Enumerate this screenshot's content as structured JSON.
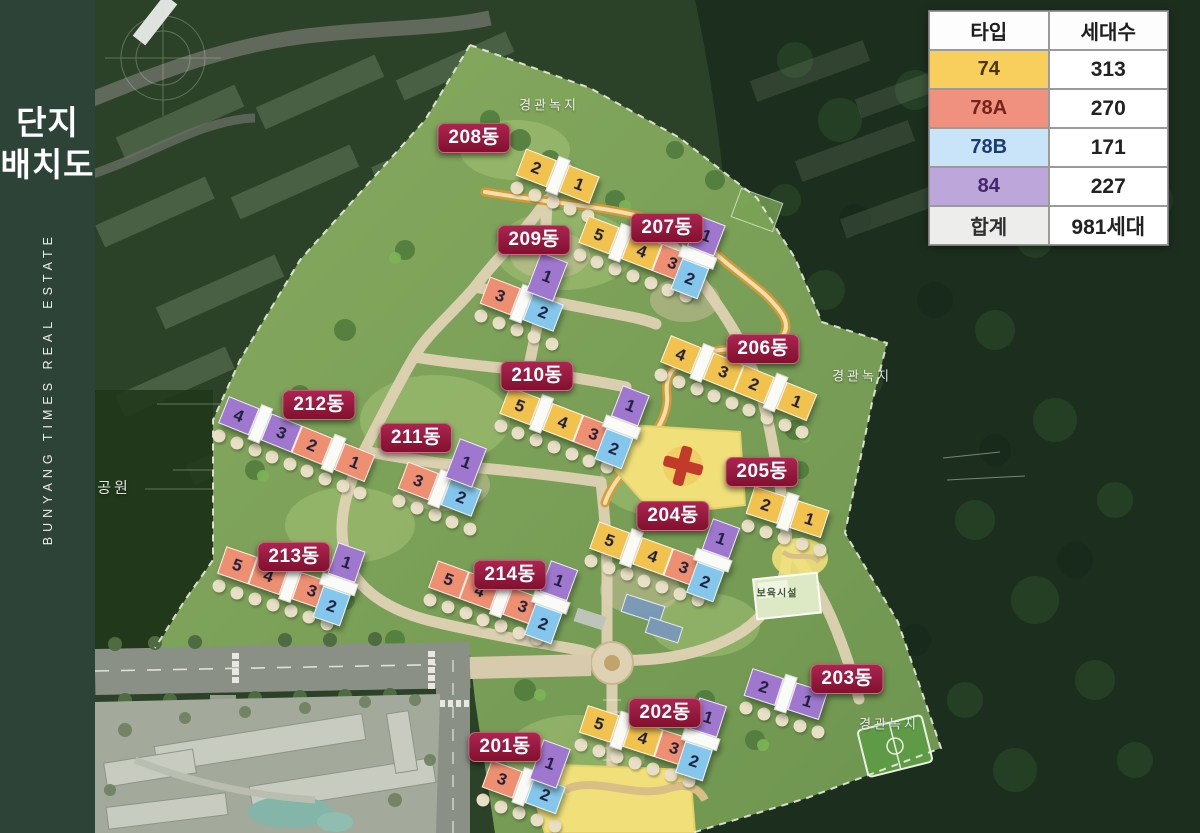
{
  "sidebar": {
    "title_line1": "단지",
    "title_line2": "배치도",
    "vertical_text": "BUNYANG TIMES REAL ESTATE"
  },
  "legend_table": {
    "headers": [
      "타입",
      "세대수"
    ],
    "rows": [
      {
        "type": "74",
        "count": "313",
        "color": "#F8CE5C",
        "text_color": "#4A3508"
      },
      {
        "type": "78A",
        "count": "270",
        "color": "#F0907E",
        "text_color": "#73231A"
      },
      {
        "type": "78B",
        "count": "171",
        "color": "#C9E4F8",
        "text_color": "#1A3C70"
      },
      {
        "type": "84",
        "count": "227",
        "color": "#BCA6DA",
        "text_color": "#45256E"
      },
      {
        "type": "합계",
        "count": "981세대",
        "color": "#EDEDEC",
        "text_color": "#2F2F2F"
      }
    ]
  },
  "map": {
    "type_colors": {
      "74": "#F2C24E",
      "78A": "#EE8F72",
      "78B": "#85C7EC",
      "84": "#9F77CE"
    },
    "badge_color": "#9A1C40",
    "area_labels": [
      {
        "text": "경관녹지",
        "x": 454,
        "y": 104,
        "size": 13
      },
      {
        "text": "경관녹지",
        "x": 767,
        "y": 375,
        "size": 13
      },
      {
        "text": "경관녹지",
        "x": 794,
        "y": 723,
        "size": 13
      },
      {
        "text": "공원",
        "x": 19,
        "y": 487,
        "size": 15
      },
      {
        "text": "보육시설",
        "x": 682,
        "y": 592,
        "size": 10
      }
    ],
    "buildings": [
      {
        "label": "208동",
        "badge": {
          "x": 379,
          "y": 138
        },
        "bars": [
          {
            "x": 462,
            "y": 178,
            "rot": 21,
            "dir": "h",
            "segs": [
              {
                "t": "74",
                "n": "2"
              },
              {
                "t": "core"
              },
              {
                "t": "74",
                "n": "1"
              }
            ]
          }
        ]
      },
      {
        "label": "207동",
        "badge": {
          "x": 572,
          "y": 228
        },
        "bars": [
          {
            "x": 540,
            "y": 251,
            "rot": 21,
            "dir": "h",
            "segs": [
              {
                "t": "74",
                "n": "5"
              },
              {
                "t": "core"
              },
              {
                "t": "74",
                "n": "4"
              },
              {
                "t": "78A",
                "n": "3"
              }
            ]
          },
          {
            "x": 605,
            "y": 258,
            "rot": 21,
            "dir": "v",
            "segs": [
              {
                "t": "84",
                "n": "1"
              },
              {
                "t": "core"
              },
              {
                "t": "78B",
                "n": "2"
              }
            ]
          }
        ]
      },
      {
        "label": "209동",
        "badge": {
          "x": 439,
          "y": 240
        },
        "bars": [
          {
            "x": 426,
            "y": 306,
            "rot": 21,
            "dir": "h",
            "segs": [
              {
                "t": "78A",
                "n": "3"
              },
              {
                "t": "core"
              },
              {
                "t": "78B",
                "n": "2"
              }
            ]
          },
          {
            "x": 452,
            "y": 277,
            "rot": 21,
            "dir": "v",
            "segs": [
              {
                "t": "84",
                "n": "1"
              }
            ]
          }
        ]
      },
      {
        "label": "206동",
        "badge": {
          "x": 668,
          "y": 349
        },
        "bars": [
          {
            "x": 643,
            "y": 380,
            "rot": 22,
            "dir": "h",
            "segs": [
              {
                "t": "74",
                "n": "4"
              },
              {
                "t": "core"
              },
              {
                "t": "74",
                "n": "3"
              },
              {
                "t": "74",
                "n": "2"
              },
              {
                "t": "core"
              },
              {
                "t": "74",
                "n": "1"
              }
            ]
          }
        ]
      },
      {
        "label": "210동",
        "badge": {
          "x": 442,
          "y": 376
        },
        "bars": [
          {
            "x": 461,
            "y": 422,
            "rot": 21,
            "dir": "h",
            "segs": [
              {
                "t": "74",
                "n": "5"
              },
              {
                "t": "core"
              },
              {
                "t": "74",
                "n": "4"
              },
              {
                "t": "78A",
                "n": "3"
              }
            ]
          },
          {
            "x": 529,
            "y": 428,
            "rot": 21,
            "dir": "v",
            "segs": [
              {
                "t": "84",
                "n": "1"
              },
              {
                "t": "core"
              },
              {
                "t": "78B",
                "n": "2"
              }
            ]
          }
        ]
      },
      {
        "label": "212동",
        "badge": {
          "x": 224,
          "y": 405
        },
        "bars": [
          {
            "x": 201,
            "y": 441,
            "rot": 22,
            "dir": "h",
            "segs": [
              {
                "t": "84",
                "n": "4"
              },
              {
                "t": "core"
              },
              {
                "t": "84",
                "n": "3"
              },
              {
                "t": "78A",
                "n": "2"
              },
              {
                "t": "core"
              },
              {
                "t": "78A",
                "n": "1"
              }
            ]
          }
        ]
      },
      {
        "label": "211동",
        "badge": {
          "x": 321,
          "y": 438
        },
        "bars": [
          {
            "x": 344,
            "y": 491,
            "rot": 21,
            "dir": "h",
            "segs": [
              {
                "t": "78A",
                "n": "3"
              },
              {
                "t": "core"
              },
              {
                "t": "78B",
                "n": "2"
              }
            ]
          },
          {
            "x": 371,
            "y": 463,
            "rot": 21,
            "dir": "v",
            "segs": [
              {
                "t": "84",
                "n": "1"
              }
            ]
          }
        ]
      },
      {
        "label": "205동",
        "badge": {
          "x": 667,
          "y": 472
        },
        "bars": [
          {
            "x": 692,
            "y": 514,
            "rot": 18,
            "dir": "h",
            "segs": [
              {
                "t": "74",
                "n": "2"
              },
              {
                "t": "core"
              },
              {
                "t": "74",
                "n": "1"
              }
            ]
          }
        ]
      },
      {
        "label": "204동",
        "badge": {
          "x": 578,
          "y": 516
        },
        "bars": [
          {
            "x": 551,
            "y": 556,
            "rot": 20,
            "dir": "h",
            "segs": [
              {
                "t": "74",
                "n": "5"
              },
              {
                "t": "core"
              },
              {
                "t": "74",
                "n": "4"
              },
              {
                "t": "78A",
                "n": "3"
              }
            ]
          },
          {
            "x": 620,
            "y": 561,
            "rot": 20,
            "dir": "v",
            "segs": [
              {
                "t": "84",
                "n": "1"
              },
              {
                "t": "core"
              },
              {
                "t": "78B",
                "n": "2"
              }
            ]
          }
        ]
      },
      {
        "label": "213동",
        "badge": {
          "x": 199,
          "y": 557
        },
        "bars": [
          {
            "x": 179,
            "y": 580,
            "rot": 19,
            "dir": "h",
            "segs": [
              {
                "t": "78A",
                "n": "5"
              },
              {
                "t": "78A",
                "n": "4"
              },
              {
                "t": "core"
              },
              {
                "t": "78A",
                "n": "3"
              }
            ]
          },
          {
            "x": 246,
            "y": 585,
            "rot": 19,
            "dir": "v",
            "segs": [
              {
                "t": "84",
                "n": "1"
              },
              {
                "t": "core"
              },
              {
                "t": "78B",
                "n": "2"
              }
            ]
          }
        ]
      },
      {
        "label": "214동",
        "badge": {
          "x": 415,
          "y": 575
        },
        "bars": [
          {
            "x": 390,
            "y": 595,
            "rot": 20,
            "dir": "h",
            "segs": [
              {
                "t": "78A",
                "n": "5"
              },
              {
                "t": "78A",
                "n": "4"
              },
              {
                "t": "core"
              },
              {
                "t": "78A",
                "n": "3"
              }
            ]
          },
          {
            "x": 458,
            "y": 603,
            "rot": 20,
            "dir": "v",
            "segs": [
              {
                "t": "84",
                "n": "1"
              },
              {
                "t": "core"
              },
              {
                "t": "78B",
                "n": "2"
              }
            ]
          }
        ]
      },
      {
        "label": "203동",
        "badge": {
          "x": 752,
          "y": 679
        },
        "bars": [
          {
            "x": 690,
            "y": 696,
            "rot": 18,
            "dir": "h",
            "segs": [
              {
                "t": "84",
                "n": "2"
              },
              {
                "t": "core"
              },
              {
                "t": "84",
                "n": "1"
              }
            ]
          }
        ]
      },
      {
        "label": "202동",
        "badge": {
          "x": 570,
          "y": 713
        },
        "bars": [
          {
            "x": 541,
            "y": 738,
            "rot": 18,
            "dir": "h",
            "segs": [
              {
                "t": "74",
                "n": "5"
              },
              {
                "t": "core"
              },
              {
                "t": "74",
                "n": "4"
              },
              {
                "t": "78A",
                "n": "3"
              }
            ]
          },
          {
            "x": 608,
            "y": 740,
            "rot": 18,
            "dir": "v",
            "segs": [
              {
                "t": "84",
                "n": "1"
              },
              {
                "t": "core"
              },
              {
                "t": "78B",
                "n": "2"
              }
            ]
          }
        ]
      },
      {
        "label": "201동",
        "badge": {
          "x": 410,
          "y": 747
        },
        "bars": [
          {
            "x": 428,
            "y": 789,
            "rot": 20,
            "dir": "h",
            "segs": [
              {
                "t": "78A",
                "n": "3"
              },
              {
                "t": "core"
              },
              {
                "t": "78B",
                "n": "2"
              }
            ]
          },
          {
            "x": 455,
            "y": 764,
            "rot": 20,
            "dir": "v",
            "segs": [
              {
                "t": "84",
                "n": "1"
              }
            ]
          }
        ]
      }
    ]
  }
}
